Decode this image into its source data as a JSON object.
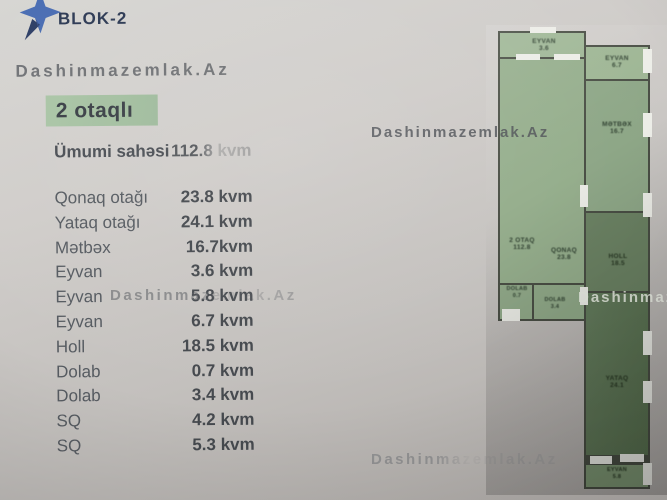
{
  "header": {
    "logo_text": "BLOK-2",
    "logo_star_color": "#4a6db3"
  },
  "watermarks": {
    "top": "Dashinmazemlak.Az",
    "middle": "Dashinmazemlak.Az",
    "table_overlay": "Dashinmazemlak.Az",
    "plan_right": "Dashinmazemlak.Az",
    "bottom": "Dashinmazemlak.Az"
  },
  "listing": {
    "title": "2 otaqlı",
    "summary_label": "Ümumi sahəsi",
    "summary_value": "112.8 kvm",
    "rows": [
      {
        "label": "Qonaq otağı",
        "value": "23.8 kvm"
      },
      {
        "label": "Yataq otağı",
        "value": "24.1 kvm"
      },
      {
        "label": "Mətbəx",
        "value": "16.7kvm"
      },
      {
        "label": "Eyvan",
        "value": "3.6 kvm"
      },
      {
        "label": "Eyvan",
        "value": "5.8 kvm"
      },
      {
        "label": "Eyvan",
        "value": "6.7 kvm"
      },
      {
        "label": "Holl",
        "value": "18.5 kvm"
      },
      {
        "label": "Dolab",
        "value": "0.7 kvm"
      },
      {
        "label": "Dolab",
        "value": "3.4 kvm"
      },
      {
        "label": "SQ",
        "value": "4.2 kvm"
      },
      {
        "label": "SQ",
        "value": "5.3 kvm"
      }
    ]
  },
  "floor_plan": {
    "colors": {
      "room_light": "#9cb493",
      "room_dark": "#5e7657",
      "wall": "#484d43",
      "window": "#ecede7"
    },
    "rooms": [
      {
        "label": "EYVAN",
        "area": "3.6"
      },
      {
        "label": "QONAQ",
        "area": "23.8"
      },
      {
        "label": "DOLAB",
        "area": "0.7"
      },
      {
        "label": "DOLAB",
        "area": "3.4"
      },
      {
        "label": "EYVAN",
        "area": "6.7"
      },
      {
        "label": "MƏTBƏX",
        "area": "16.7"
      },
      {
        "label": "HOLL",
        "area": "18.5"
      },
      {
        "label": "YATAQ",
        "area": "24.1"
      },
      {
        "label": "EYVAN",
        "area": "5.8"
      },
      {
        "label": "2 OTAQ",
        "area": "112.8"
      }
    ]
  }
}
